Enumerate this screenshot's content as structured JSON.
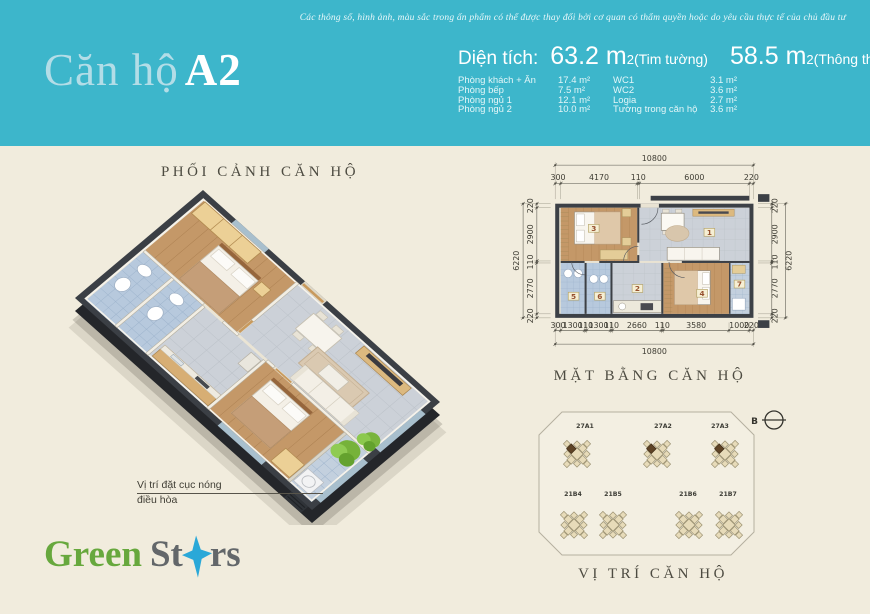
{
  "header": {
    "title": {
      "light": "Căn hộ",
      "bold": "A2"
    },
    "disclaimer": "Các thông số, hình ảnh, màu sắc trong ấn phẩm có thể được thay đổi bởi cơ quan có thẩm quyền hoặc do yêu cầu thực tế của chủ đầu tư",
    "area": {
      "label": "Diện tích:",
      "value1": "63.2 m",
      "sup": "2",
      "note1": "(Tim tường)",
      "value2": "58.5 m",
      "note2": "(Thông thủy)"
    },
    "rooms_left": [
      {
        "label": "Phòng khách + Ăn",
        "value": "17.4 m²"
      },
      {
        "label": "Phòng bếp",
        "value": "7.5 m²"
      },
      {
        "label": "Phòng ngủ 1",
        "value": "12.1 m²"
      },
      {
        "label": "Phòng ngủ 2",
        "value": "10.0 m²"
      }
    ],
    "rooms_right": [
      {
        "label": "WC1",
        "value": "3.1 m²"
      },
      {
        "label": "WC2",
        "value": "3.6 m²"
      },
      {
        "label": "Logia",
        "value": "2.7 m²"
      },
      {
        "label": "Tường trong căn hộ",
        "value": "3.6 m²"
      }
    ]
  },
  "perspective": {
    "title": "PHỐI CẢNH CĂN HỘ",
    "ac_note": [
      "Vị trí đặt cục nóng",
      "điều hòa"
    ]
  },
  "floorplan": {
    "title": "MẶT BẰNG CĂN HỘ",
    "dims": {
      "top_total": "10800",
      "top_segments": [
        "300",
        "4170",
        "110",
        "6000",
        "220"
      ],
      "bottom_segments": [
        "300",
        "1300",
        "110",
        "1300",
        "110",
        "2660",
        "110",
        "3580",
        "1000",
        "220"
      ],
      "bottom_total": "10800",
      "left_total": "6220",
      "left_segments": [
        "220",
        "2900",
        "110",
        "2770",
        "220"
      ],
      "right_segments": [
        "220",
        "2900",
        "110",
        "2770",
        "220"
      ],
      "right_total": "6220"
    },
    "room_numbers": [
      "1",
      "2",
      "3",
      "4",
      "5",
      "6",
      "7"
    ]
  },
  "location": {
    "title": "VỊ TRÍ CĂN HỘ",
    "compass": "B",
    "buildings_top": [
      "27A1",
      "27A2",
      "27A3"
    ],
    "buildings_bottom": [
      "21B4",
      "21B5",
      "21B6",
      "21B7"
    ]
  },
  "logo": {
    "green": "Green",
    "gray1": "St",
    "gray2": "rs"
  },
  "colors": {
    "teal": "#3db6cb",
    "cream": "#f1ecdd",
    "wall": "#3b3f45",
    "wood": "#c49868",
    "tile_blue": "#b7c9dd",
    "tile_gray": "#ccd1d8",
    "logo_green": "#67a83d",
    "logo_gray": "#63676a",
    "logo_blue": "#2aa8d8"
  }
}
